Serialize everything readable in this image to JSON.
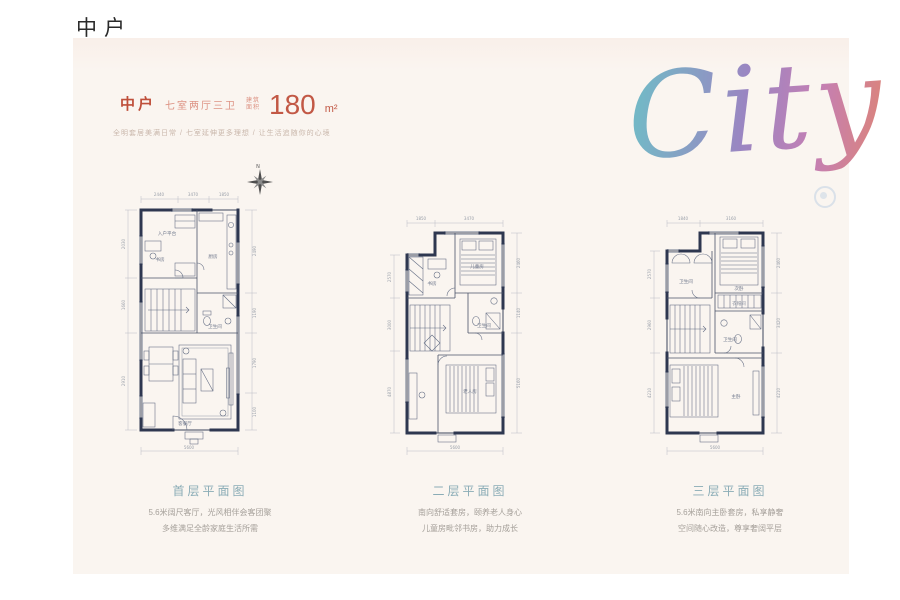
{
  "page": {
    "title": "中户"
  },
  "brand": {
    "script_text": "City"
  },
  "header": {
    "unit": "中户",
    "layout": "七室两厅三卫",
    "area_label_top": "建筑",
    "area_label_bottom": "面积",
    "area_value": "180",
    "area_unit": "m²",
    "tagline": "全明套居美满日常 / 七室延伸更多理想 / 让生活追随你的心境"
  },
  "compass": {
    "north": "N"
  },
  "colors": {
    "card_bg": "#faf5f0",
    "accent_red": "#c25845",
    "caption_teal": "#8aacb6",
    "plan_line": "#2e3750",
    "gradient": [
      "#74b7c6",
      "#9a86c2",
      "#c47fb4",
      "#e0856f"
    ]
  },
  "plans": [
    {
      "caption": "首层平面图",
      "desc_line1": "5.6米阔尺客厅，光风相伴会客团聚",
      "desc_line2": "多维满足全龄家庭生活所需",
      "rooms": {
        "entry": "入户平台",
        "study": "书房",
        "kitchen": "厨房",
        "bath": "卫生间",
        "living": "客餐厅"
      },
      "dims": {
        "top": [
          "2440",
          "3470",
          "1850"
        ],
        "left": [
          "2030",
          "1660",
          "2910"
        ],
        "right": [
          "2490",
          "1190",
          "1790",
          "1100"
        ],
        "bottom": "5600"
      }
    },
    {
      "caption": "二层平面图",
      "desc_line1": "南向舒适套房，颐养老人身心",
      "desc_line2": "儿童房毗邻书房，助力成长",
      "rooms": {
        "study": "书房",
        "child": "儿童房",
        "bath": "卫生间",
        "elder": "老人房"
      },
      "dims": {
        "top": [
          "1850",
          "3470"
        ],
        "left": [
          "2570",
          "3000",
          "4870"
        ],
        "right": [
          "2460",
          "1140",
          "5160"
        ],
        "bottom": "5600"
      }
    },
    {
      "caption": "三层平面图",
      "desc_line1": "5.6米南向主卧套房，私享静奢",
      "desc_line2": "空间随心改造，尊享奢阔平层",
      "rooms": {
        "bath1": "卫生间",
        "second": "次卧",
        "cloak": "衣帽间",
        "bath2": "卫生间",
        "master": "主卧"
      },
      "dims": {
        "top": [
          "1840",
          "3160"
        ],
        "left": [
          "2570",
          "2960",
          "4210"
        ],
        "right": [
          "2460",
          "3420",
          "4210"
        ],
        "bottom": "5600"
      }
    }
  ]
}
